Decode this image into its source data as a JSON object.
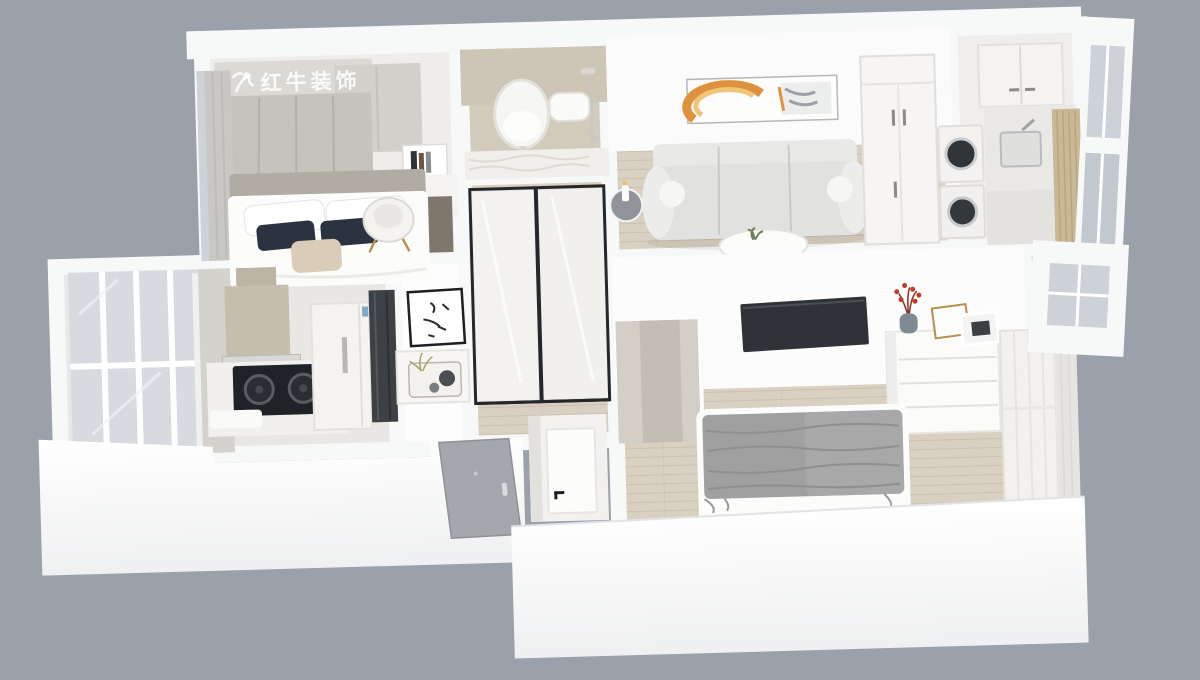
{
  "watermark": {
    "text": "红牛装饰"
  },
  "palette": {
    "bg": "#9aa1ab",
    "wall": "#f7f8f8",
    "wall-bright": "#fdfdfd",
    "wall-shade": "#e7e8ea",
    "tan-wall": "#d2cabb",
    "floor-wood": "#d9d0c2",
    "floor-wood-line": "#cbc0af",
    "floor-pale": "#eae8e4",
    "wardrobe-gray": "#c6c3bd",
    "glass": "#ccd2d8",
    "glass-deep": "#c2c8cf",
    "dark": "#24282d",
    "charcoal": "#3d4145",
    "door-gray": "#a4a7ac",
    "sofa": "#e1e1df",
    "sofa-back": "#e8e8e6",
    "accent-orange": "#df923e",
    "accent-orange-light": "#f1c477",
    "gold": "#b6904f",
    "navy": "#2b3340",
    "beige": "#d9ccb8",
    "throw": "#a0a0a0",
    "berry-red": "#c23a2c",
    "watermark-white": "rgba(255,255,255,0.85)"
  },
  "scene": {
    "type": "3d-apartment-floorplan-render",
    "view": "top-down-dollhouse"
  },
  "rooms": [
    {
      "name": "second-bedroom",
      "furniture": [
        "gray-wardrobe",
        "white-wardrobe",
        "book-shelf",
        "desk",
        "armchair",
        "double-bed",
        "white-pillows",
        "navy-pillows",
        "beige-pillow",
        "window-curtain"
      ]
    },
    {
      "name": "bathroom",
      "furniture": [
        "oval-mirror",
        "vanity-counter",
        "wall-hung-toilet",
        "shower-set"
      ]
    },
    {
      "name": "hallway",
      "furniture": [
        "frosted-sliding-doors",
        "wood-floor"
      ]
    },
    {
      "name": "living-room",
      "furniture": [
        "abstract-wall-art",
        "three-seat-sofa",
        "round-side-table",
        "candle",
        "coffee-table",
        "plant",
        "wardrobe-cabinet",
        "stacked-washer-dryer"
      ]
    },
    {
      "name": "utility-kitchenette",
      "furniture": [
        "upper-cabinets",
        "sink-counter",
        "window-wall",
        "bamboo-blind"
      ]
    },
    {
      "name": "balcony",
      "furniture": [
        "window-wall"
      ]
    },
    {
      "name": "kitchen",
      "furniture": [
        "range-hood",
        "gas-cooktop",
        "counter",
        "refrigerator",
        "tall-dark-cabinet"
      ]
    },
    {
      "name": "dining-nook",
      "furniture": [
        "calligraphy-art",
        "console-table",
        "tray-with-plant-and-bowls"
      ]
    },
    {
      "name": "entry",
      "furniture": [
        "front-door",
        "interior-white-door"
      ]
    },
    {
      "name": "master-bedroom",
      "furniture": [
        "wall-mounted-tv",
        "dresser",
        "flower-vase",
        "photo-frames",
        "double-bed",
        "gray-throw-blanket",
        "sliding-wardrobe",
        "sheer-curtain",
        "window-bay"
      ]
    }
  ]
}
